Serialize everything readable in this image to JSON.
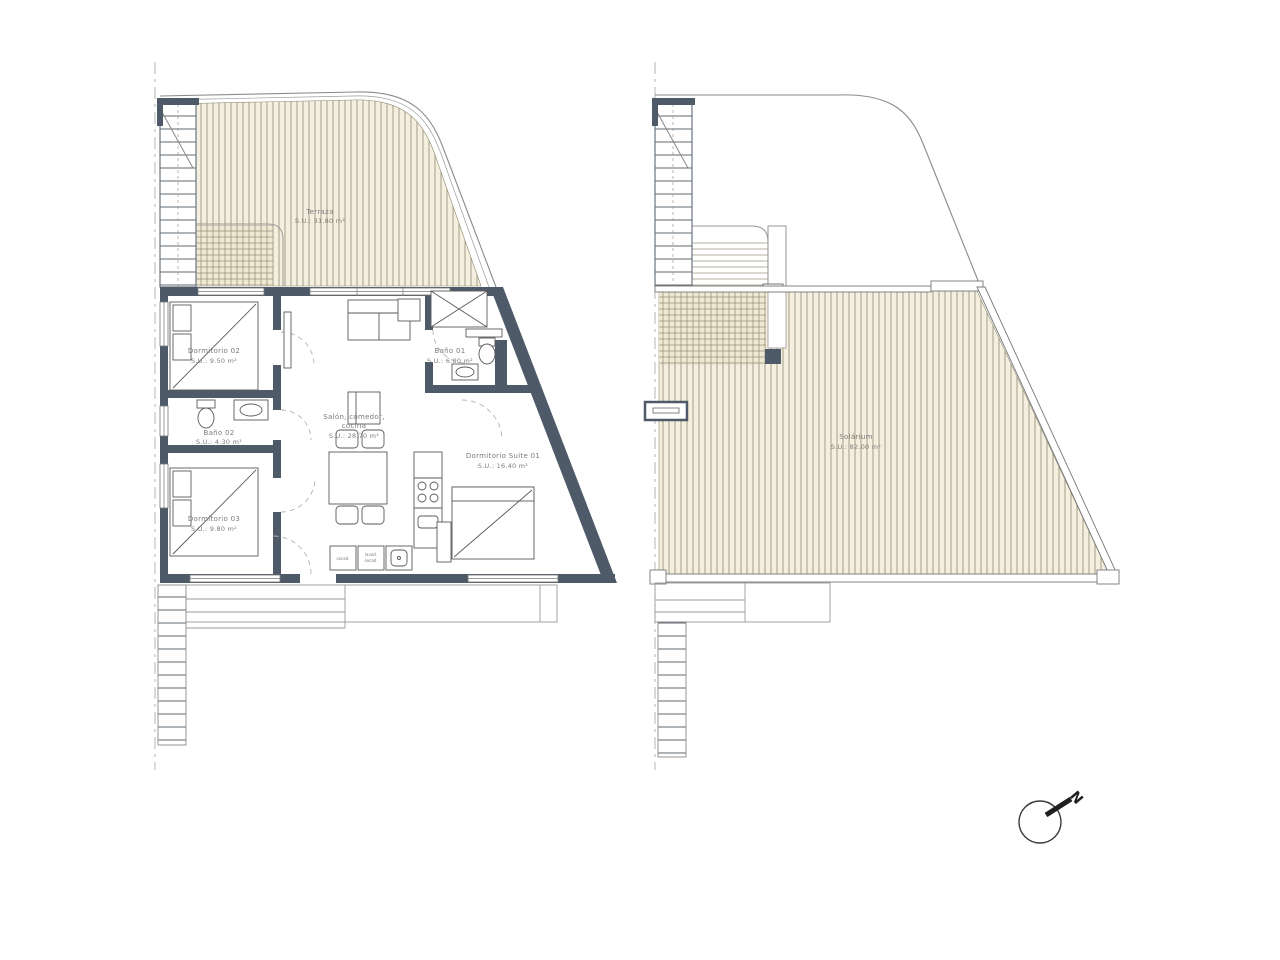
{
  "document": {
    "type": "architectural floor plan, two plans side by side"
  },
  "left_plan": {
    "terraza": {
      "name": "Terraza",
      "area": "S.U.: 31.80 m²"
    },
    "dormitorio02": {
      "name": "Dormitorio 02",
      "area": "S.U.: 9.50 m²"
    },
    "bano02": {
      "name": "Baño 02",
      "area": "S.U.: 4.30 m²"
    },
    "dormitorio03": {
      "name": "Dormitorio 03",
      "area": "S.U.: 9.80 m²"
    },
    "salon": {
      "name_line1": "Salón, comedor,",
      "name_line2": "cocina",
      "area": "S.U.: 28.70 m²"
    },
    "bano01": {
      "name": "Baño 01",
      "area": "S.U.: 6.00 m²"
    },
    "suite01": {
      "name": "Dormitorio Suite 01",
      "area": "S.U.: 16.40 m²"
    },
    "utility": {
      "box1_label": "secad.",
      "box2_label1": "lavad.",
      "box2_label2": "secad."
    }
  },
  "right_plan": {
    "solarium": {
      "name": "Solárium",
      "area": "S.U.: 82.00 m²"
    }
  },
  "compass": {
    "north": "N"
  },
  "colors": {
    "wall": "#4e5a68",
    "hatch_fill": "#f4efdf",
    "hatch_line": "#8f8a73",
    "outline": "#8a8a8a",
    "text": "#7b7b7b"
  }
}
